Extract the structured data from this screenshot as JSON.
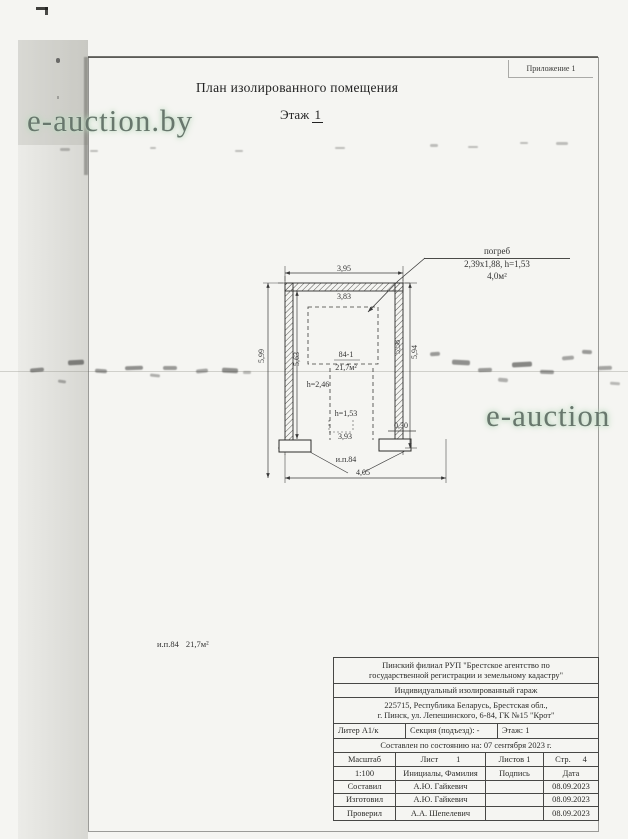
{
  "page": {
    "appendix": "Приложение 1",
    "title": "План изолированного помещения",
    "floor_label": "Этаж",
    "floor_number": "1"
  },
  "watermarks": {
    "left": "e-auction.by",
    "right": "e-auction",
    "text_color": "#68776d",
    "glow_color": "#bcd9bf"
  },
  "plan": {
    "cellar_label": "погреб",
    "cellar_dims": "2,39х1,88, h=1,53",
    "cellar_area": "4,0м²",
    "dim_top_outer": "3,95",
    "dim_top_inner": "3,83",
    "dim_left_outer": "5,99",
    "dim_left_inner": "5,63",
    "dim_right_inner": "5,58",
    "dim_right_outer": "5,94",
    "room_number": "84-1",
    "room_area": "21,7м²",
    "room_height": "h=2,46",
    "pit_height": "h=1,53",
    "dim_pit_width": "3,93",
    "dim_pilaster": "0,30",
    "opening_label": "и.п.84",
    "dim_bottom": "4,05"
  },
  "summary": {
    "premises_label": "и.п.84",
    "premises_area": "21,7м²"
  },
  "title_block": {
    "agency_line1": "Пинский филиал РУП \"Брестское агентство по",
    "agency_line2": "государственной регистрации и земельному кадастру\"",
    "object_type": "Индивидуальный изолированный гараж",
    "address_line1": "225715, Республика Беларусь, Брестская обл.,",
    "address_line2": "г. Пинск, ул. Лепешинского, 6-84, ГК №15 \"Крот\"",
    "liter": "Литер А1/к",
    "section": "Секция (подъезд): -",
    "floor": "Этаж: 1",
    "compiled": "Составлен по состоянию на: 07 сентября 2023 г.",
    "scale_label": "Масштаб",
    "sheet_label": "Лист",
    "sheet_value": "1",
    "sheets_label": "Листов 1",
    "page_label": "Стр.",
    "page_value": "4",
    "scale_value": "1:100",
    "initials_label": "Инициалы, Фамилия",
    "signature_label": "Подпись",
    "date_label": "Дата",
    "rows": [
      {
        "role": "Составил",
        "name": "А.Ю. Гайкевич",
        "signature": "",
        "date": "08.09.2023"
      },
      {
        "role": "Изготовил",
        "name": "А.Ю. Гайкевич",
        "signature": "",
        "date": "08.09.2023"
      },
      {
        "role": "Проверил",
        "name": "А.А. Шепелевич",
        "signature": "",
        "date": "08.09.2023"
      }
    ]
  },
  "colors": {
    "paper": "#f5f5f2",
    "ink": "#2f2f2f"
  }
}
